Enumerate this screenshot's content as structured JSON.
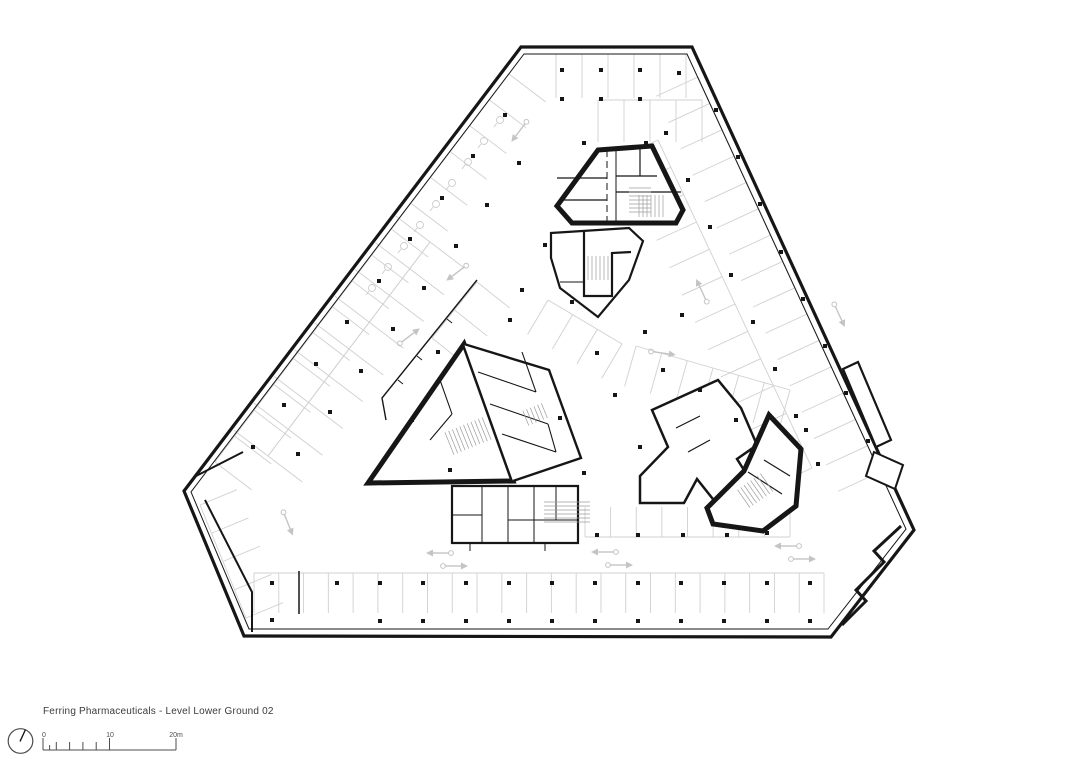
{
  "caption": {
    "title": "Ferring Pharmaceuticals - Level Lower Ground 02"
  },
  "scalebar": {
    "baseline": {
      "x1": 43,
      "x2": 176,
      "y": 750
    },
    "ticks": [
      [
        43,
        12
      ],
      [
        49.6,
        5
      ],
      [
        56.3,
        8
      ],
      [
        69.6,
        8
      ],
      [
        82.9,
        8
      ],
      [
        96.2,
        8
      ],
      [
        109.5,
        12
      ],
      [
        176,
        12
      ]
    ],
    "labels": [
      {
        "text": "0",
        "x": 44
      },
      {
        "text": "10",
        "x": 110
      },
      {
        "text": "20m",
        "x": 176
      }
    ]
  },
  "north_indicator": {
    "cx": 20.5,
    "cy": 741,
    "r": 12.3,
    "needle": "M 25.5,729.5 L 20,741.5"
  },
  "colors": {
    "background": "#ffffff",
    "wall": "#161616",
    "stall": "#d0d0d0",
    "arrow": "#c4c4c4",
    "hatch": "#9c9c9c",
    "icon": "#cccccc",
    "text": "#3b3b3b",
    "scale": "#4d4d4d"
  },
  "plan": {
    "perimeter": {
      "outer": "M 521,47 L 692,47 L 914,530 L 831,637 L 244,636 L 184,491 Z",
      "inner": "M 524,54 L 687,54 L 906,529 L 828,629 L 249,629 L 191,492 Z"
    },
    "details": [
      {
        "d": "M 843,369 L 858,362 L 891,440 L 876,447 Z",
        "w": 2.2,
        "fill": "#ffffff"
      },
      {
        "d": "M 874,452 L 903,465 L 895,489 L 866,476 Z",
        "w": 2.0,
        "fill": "#ffffff"
      },
      {
        "d": "M 901,526 L 874,551 L 884,562 L 856,590 L 866,601 L 842,625",
        "w": 3.0
      },
      {
        "d": "M 477,280 L 382,398 L 386,420",
        "w": 1.4
      },
      {
        "d": "M 447,319 L 452,323 M 417,356 L 422,360 M 398,380 L 403,384",
        "w": 1.0
      },
      {
        "d": "M 196,476 L 243,452",
        "w": 2.0
      },
      {
        "d": "M 205,500 L 252,592 L 252,632",
        "w": 2.0
      },
      {
        "d": "M 299,571 L 299,614",
        "w": 1.5
      }
    ],
    "cores": [
      {
        "d": "M 598,150 L 652,146 L 683,210 L 676,223 L 572,223 L 557,206 Z",
        "w": 5,
        "fill": "#ffffff"
      },
      {
        "d": "M 607,150 L 607,223",
        "w": 1,
        "dash": "7 4"
      },
      {
        "d": "M 616,150 L 616,223",
        "w": 1
      },
      {
        "d": "M 557,178 L 607,178 M 563,200 L 607,200 M 616,176 L 657,176 M 640,148 L 640,176 M 616,192 L 681,192",
        "w": 1.2
      },
      {
        "d": "M 551,233 L 629,228 L 643,241 L 629,280 L 598,317 L 560,288 L 551,258 Z",
        "w": 2.2,
        "fill": "#ffffff"
      },
      {
        "d": "M 584,231 L 584,296 L 612,296 L 612,253 L 631,252",
        "w": 2.2
      },
      {
        "d": "M 560,282 L 584,282",
        "w": 1
      },
      {
        "d": "M 464,344 L 513,481 L 368,483 Z",
        "w": 5,
        "fill": "#ffffff"
      },
      {
        "d": "M 464,344 L 549,370 L 581,458 L 513,481",
        "w": 2.4,
        "fill": "#ffffff"
      },
      {
        "d": "M 478,372 L 536,392 M 490,404 L 548,424 M 502,434 L 556,452 M 522,352 L 536,392 M 548,424 L 556,452 M 440,380 L 452,414 M 452,414 L 430,440",
        "w": 1.1
      },
      {
        "d": "M 452,486 L 578,486 L 578,543 L 452,543 Z",
        "w": 2.2,
        "fill": "#ffffff"
      },
      {
        "d": "M 482,486 L 482,543 M 508,486 L 508,543 M 534,486 L 534,543 M 452,515 L 482,515 M 508,520 L 578,520 M 556,486 L 556,520",
        "w": 1
      },
      {
        "d": "M 470,543 L 470,551 M 545,543 L 545,551",
        "w": 1
      },
      {
        "d": "M 718,380 L 652,410 L 668,447 L 640,476 L 640,503 L 684,503 L 697,479 L 724,513 L 756,489 L 737,459 L 757,445 L 741,408 Z",
        "w": 2.5,
        "fill": "#ffffff"
      },
      {
        "d": "M 769,415 L 801,449 L 796,506 L 763,531 L 713,524 L 707,508 L 744,471 Z",
        "w": 5,
        "fill": "#ffffff"
      },
      {
        "d": "M 676,428 L 700,416 M 688,452 L 710,440 M 748,472 L 782,494 M 764,460 L 790,476",
        "w": 1.2
      }
    ],
    "stall_rows": [
      {
        "x1": 556,
        "y1": 54,
        "x2": 686,
        "y2": 54,
        "nx": 0,
        "ny": 1,
        "depth": 44,
        "n": 5
      },
      {
        "x1": 598,
        "y1": 100,
        "x2": 702,
        "y2": 100,
        "nx": 0,
        "ny": 1,
        "depth": 42,
        "n": 4
      },
      {
        "x1": 698,
        "y1": 77,
        "x2": 880,
        "y2": 472,
        "nx": -0.908,
        "ny": 0.418,
        "depth": 46,
        "n": 15
      },
      {
        "x1": 658,
        "y1": 140,
        "x2": 812,
        "y2": 468,
        "nx": -0.908,
        "ny": 0.418,
        "depth": 44,
        "n": 12
      },
      {
        "x1": 509,
        "y1": 74,
        "x2": 215,
        "y2": 462,
        "nx": 0.797,
        "ny": 0.605,
        "depth": 46,
        "n": 15
      },
      {
        "x1": 430,
        "y1": 242,
        "x2": 268,
        "y2": 456,
        "nx": 0.797,
        "ny": 0.605,
        "depth": 43,
        "n": 8
      },
      {
        "x1": 430,
        "y1": 242,
        "x2": 268,
        "y2": 456,
        "nx": -0.797,
        "ny": -0.605,
        "depth": 43,
        "n": 8
      },
      {
        "x1": 254,
        "y1": 573,
        "x2": 824,
        "y2": 573,
        "nx": 0,
        "ny": 1,
        "depth": 40,
        "n": 23
      },
      {
        "x1": 585,
        "y1": 537,
        "x2": 790,
        "y2": 537,
        "nx": 0,
        "ny": -1,
        "depth": 30,
        "n": 8
      },
      {
        "x1": 200,
        "y1": 505,
        "x2": 246,
        "y2": 618,
        "nx": 0.924,
        "ny": -0.382,
        "depth": 40,
        "n": 4
      },
      {
        "x1": 636,
        "y1": 346,
        "x2": 790,
        "y2": 390,
        "nx": -0.27,
        "ny": 0.96,
        "depth": 42,
        "n": 6
      },
      {
        "x1": 548,
        "y1": 300,
        "x2": 622,
        "y2": 344,
        "nx": -0.51,
        "ny": 0.86,
        "depth": 40,
        "n": 3
      },
      {
        "x1": 477,
        "y1": 282,
        "x2": 432,
        "y2": 338,
        "nx": 0.78,
        "ny": 0.62,
        "depth": 42,
        "n": 2
      }
    ],
    "stall_icons": [
      [
        500,
        120
      ],
      [
        484,
        141
      ],
      [
        468,
        162
      ],
      [
        452,
        183
      ],
      [
        436,
        204
      ],
      [
        420,
        225
      ],
      [
        404,
        246
      ],
      [
        388,
        267
      ],
      [
        372,
        288
      ]
    ],
    "columns": [
      [
        337,
        583
      ],
      [
        380,
        583
      ],
      [
        423,
        583
      ],
      [
        466,
        583
      ],
      [
        509,
        583
      ],
      [
        552,
        583
      ],
      [
        595,
        583
      ],
      [
        638,
        583
      ],
      [
        681,
        583
      ],
      [
        724,
        583
      ],
      [
        767,
        583
      ],
      [
        810,
        583
      ],
      [
        380,
        621
      ],
      [
        423,
        621
      ],
      [
        466,
        621
      ],
      [
        509,
        621
      ],
      [
        552,
        621
      ],
      [
        595,
        621
      ],
      [
        638,
        621
      ],
      [
        681,
        621
      ],
      [
        724,
        621
      ],
      [
        767,
        621
      ],
      [
        810,
        621
      ],
      [
        272,
        583
      ],
      [
        272,
        620
      ],
      [
        505,
        115
      ],
      [
        473,
        156
      ],
      [
        442,
        198
      ],
      [
        410,
        239
      ],
      [
        379,
        281
      ],
      [
        347,
        322
      ],
      [
        316,
        364
      ],
      [
        284,
        405
      ],
      [
        253,
        447
      ],
      [
        519,
        163
      ],
      [
        487,
        205
      ],
      [
        456,
        246
      ],
      [
        424,
        288
      ],
      [
        393,
        329
      ],
      [
        361,
        371
      ],
      [
        330,
        412
      ],
      [
        298,
        454
      ],
      [
        562,
        70
      ],
      [
        601,
        70
      ],
      [
        640,
        70
      ],
      [
        679,
        73
      ],
      [
        562,
        99
      ],
      [
        601,
        99
      ],
      [
        640,
        99
      ],
      [
        584,
        143
      ],
      [
        646,
        143
      ],
      [
        716,
        110
      ],
      [
        738,
        157
      ],
      [
        760,
        204
      ],
      [
        781,
        252
      ],
      [
        803,
        299
      ],
      [
        825,
        346
      ],
      [
        846,
        393
      ],
      [
        868,
        441
      ],
      [
        666,
        133
      ],
      [
        688,
        180
      ],
      [
        710,
        227
      ],
      [
        731,
        275
      ],
      [
        753,
        322
      ],
      [
        775,
        369
      ],
      [
        796,
        416
      ],
      [
        818,
        464
      ],
      [
        572,
        302
      ],
      [
        645,
        332
      ],
      [
        682,
        315
      ],
      [
        597,
        353
      ],
      [
        663,
        370
      ],
      [
        615,
        395
      ],
      [
        560,
        418
      ],
      [
        522,
        290
      ],
      [
        545,
        245
      ],
      [
        700,
        390
      ],
      [
        736,
        420
      ],
      [
        806,
        430
      ],
      [
        597,
        535
      ],
      [
        638,
        535
      ],
      [
        683,
        535
      ],
      [
        727,
        535
      ],
      [
        767,
        533
      ],
      [
        584,
        473
      ],
      [
        438,
        352
      ],
      [
        412,
        420
      ],
      [
        450,
        470
      ],
      [
        510,
        320
      ],
      [
        640,
        447
      ]
    ],
    "arrows": [
      [
        403,
        341,
        -37
      ],
      [
        463,
        268,
        143
      ],
      [
        447,
        553,
        180
      ],
      [
        447,
        566,
        0
      ],
      [
        612,
        552,
        180
      ],
      [
        612,
        565,
        0
      ],
      [
        795,
        546,
        180
      ],
      [
        795,
        559,
        0
      ],
      [
        285,
        516,
        68
      ],
      [
        836,
        308,
        65
      ],
      [
        705,
        298,
        245
      ],
      [
        524,
        125,
        127
      ],
      [
        655,
        352,
        8
      ]
    ],
    "hatches": [
      [
        652,
        206,
        26,
        22,
        0
      ],
      [
        640,
        200,
        24,
        22,
        90
      ],
      [
        598,
        268,
        20,
        24,
        0
      ],
      [
        468,
        436,
        40,
        24,
        -22
      ],
      [
        536,
        414,
        22,
        16,
        -22
      ],
      [
        756,
        490,
        30,
        22,
        -35
      ],
      [
        567,
        512,
        20,
        46,
        90
      ]
    ]
  }
}
